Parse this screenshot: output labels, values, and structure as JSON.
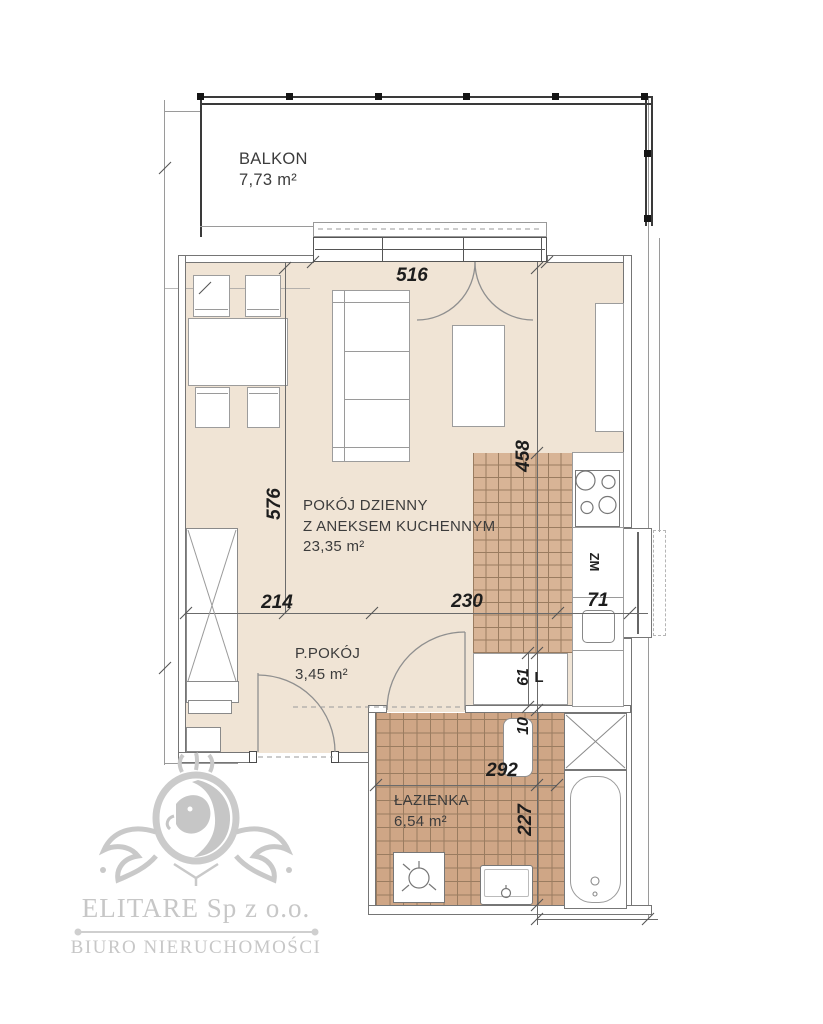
{
  "plan": {
    "balcony": {
      "name": "BALKON",
      "area": "7,73 m²"
    },
    "living_room": {
      "line1": "POKÓJ DZIENNY",
      "line2": "Z ANEKSEM KUCHENNYM",
      "area": "23,35 m²"
    },
    "hallway": {
      "name": "P.POKÓJ",
      "area": "3,45 m²"
    },
    "bathroom": {
      "name": "ŁAZIENKA",
      "area": "6,54 m²"
    },
    "dimensions": {
      "balcony_window_width": "516",
      "living_depth": "576",
      "kitchen_depth": "458",
      "living_width_left": "214",
      "living_width_right": "230",
      "sink_width": "71",
      "counter_width": "61",
      "duct_width": "10",
      "bathroom_width": "292",
      "bathroom_depth": "227"
    },
    "appliances": {
      "dishwasher": "ZM",
      "fridge": "L"
    }
  },
  "watermark": {
    "company": "ELITARE Sp z o.o.",
    "tagline": "BIURO NIERUCHOMOŚCI"
  },
  "colors": {
    "floor": "#f0e4d5",
    "kitchen_tile": "#d8b496",
    "bath_tile": "#cfa686",
    "tile_grid": "#9a7c60",
    "wall": "#757575",
    "line": "#9a9a9a",
    "rail": "#3a3a3a",
    "furn": "#9c9c9c",
    "dimline": "#6b6b6b",
    "dim": "#1d1d1d",
    "text": "#3c3c3c",
    "watermark": "#c7c7c7"
  }
}
